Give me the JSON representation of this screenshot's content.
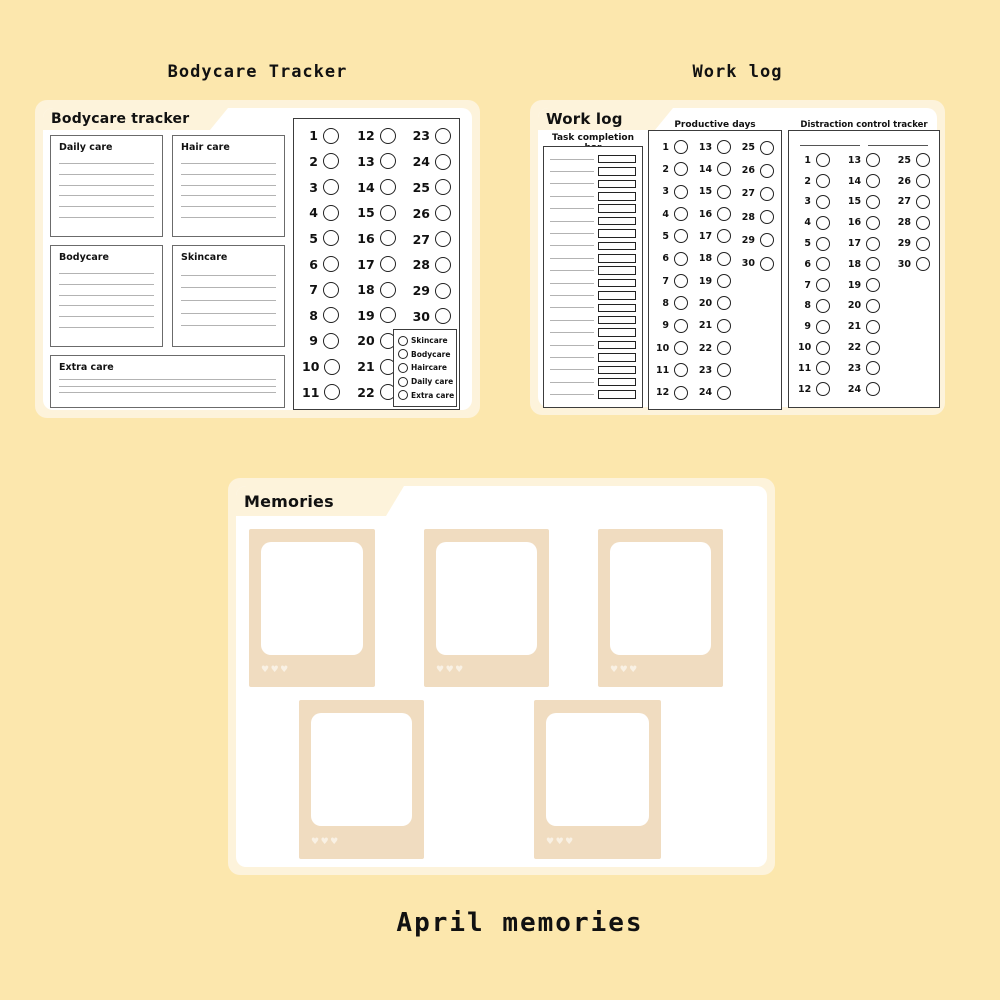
{
  "colors": {
    "background": "#FCE7AD",
    "card": "#FDF3DB",
    "panel": "#FFFFFF",
    "frame": "#F0DCC0",
    "hearts": "#F9F1E4",
    "text": "#111111"
  },
  "page_headings": {
    "left": "Bodycare Tracker",
    "right": "Work log",
    "bottom": "April memories"
  },
  "bodycare_card": {
    "title": "Bodycare tracker",
    "boxes": {
      "daily": {
        "label": "Daily care",
        "lines": 6
      },
      "hair": {
        "label": "Hair care",
        "lines": 6
      },
      "body": {
        "label": "Bodycare",
        "lines": 6
      },
      "skin": {
        "label": "Skincare",
        "lines": 5
      },
      "extra": {
        "label": "Extra care",
        "lines": 3
      }
    },
    "day_tracker": {
      "columns": [
        [
          1,
          2,
          3,
          4,
          5,
          6,
          7,
          8,
          9,
          10,
          11
        ],
        [
          12,
          13,
          14,
          15,
          16,
          17,
          18,
          19,
          20,
          21,
          22
        ],
        [
          23,
          24,
          25,
          26,
          27,
          28,
          29,
          30
        ]
      ],
      "legend": [
        "Skincare",
        "Bodycare",
        "Haircare",
        "Daily care",
        "Extra care"
      ]
    }
  },
  "worklog_card": {
    "title": "Work log",
    "task_completion": {
      "title": "Task completion bar",
      "rows": 20
    },
    "productive_days": {
      "title": "Productive days",
      "columns": [
        [
          1,
          2,
          3,
          4,
          5,
          6,
          7,
          8,
          9,
          10,
          11,
          12
        ],
        [
          13,
          14,
          15,
          16,
          17,
          18,
          19,
          20,
          21,
          22,
          23,
          24
        ],
        [
          25,
          26,
          27,
          28,
          29,
          30
        ]
      ]
    },
    "distraction_tracker": {
      "title": "Distraction control tracker",
      "blank_lines": 2,
      "columns": [
        [
          1,
          2,
          3,
          4,
          5,
          6,
          7,
          8,
          9,
          10,
          11,
          12
        ],
        [
          13,
          14,
          15,
          16,
          17,
          18,
          19,
          20,
          21,
          22,
          23,
          24
        ],
        [
          25,
          26,
          27,
          28,
          29,
          30
        ]
      ]
    }
  },
  "memories_card": {
    "title": "Memories",
    "frames": [
      {
        "hearts": "♥♥♥"
      },
      {
        "hearts": "♥♥♥"
      },
      {
        "hearts": "♥♥♥"
      },
      {
        "hearts": "♥♥♥"
      },
      {
        "hearts": "♥♥♥"
      }
    ]
  }
}
